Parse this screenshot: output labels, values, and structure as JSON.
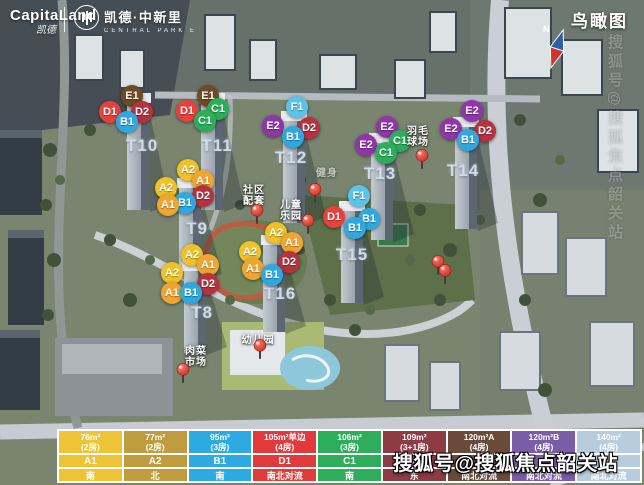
{
  "header": {
    "brand": "CapitaLand",
    "brand_sub": "凯德",
    "project": "凯德·中新里",
    "project_sub": "CENTRAL PARK E",
    "view_label": "鸟瞰图",
    "compass_n": "N"
  },
  "watermarks": {
    "bottom": "搜狐号@搜狐焦点韶关站",
    "side_vertical": "搜狐号@搜狐焦点韶关站"
  },
  "marker_colors": {
    "A1": "#F0A431",
    "A2": "#EFC228",
    "B1": "#2EA9E0",
    "C1": "#2BAE5B",
    "D1": "#E8403C",
    "D2": "#B5323F",
    "E1": "#6F4A24",
    "E2": "#9036A8",
    "F1": "#59C3EA"
  },
  "towers": [
    {
      "id": "T10",
      "x": 142,
      "y": 146
    },
    {
      "id": "T11",
      "x": 217,
      "y": 146
    },
    {
      "id": "T12",
      "x": 291,
      "y": 158
    },
    {
      "id": "T13",
      "x": 380,
      "y": 174
    },
    {
      "id": "T14",
      "x": 463,
      "y": 171
    },
    {
      "id": "T9",
      "x": 197,
      "y": 229
    },
    {
      "id": "T15",
      "x": 352,
      "y": 255
    },
    {
      "id": "T16",
      "x": 280,
      "y": 294
    },
    {
      "id": "T8",
      "x": 202,
      "y": 313
    }
  ],
  "unit_markers": [
    {
      "t": "E1",
      "x": 132,
      "y": 96
    },
    {
      "t": "D1",
      "x": 110,
      "y": 112
    },
    {
      "t": "D2",
      "x": 142,
      "y": 112
    },
    {
      "t": "B1",
      "x": 127,
      "y": 122
    },
    {
      "t": "E1",
      "x": 208,
      "y": 96
    },
    {
      "t": "D1",
      "x": 187,
      "y": 111
    },
    {
      "t": "C1",
      "x": 218,
      "y": 109
    },
    {
      "t": "C1",
      "x": 205,
      "y": 121
    },
    {
      "t": "F1",
      "x": 297,
      "y": 107
    },
    {
      "t": "E2",
      "x": 273,
      "y": 126
    },
    {
      "t": "D2",
      "x": 309,
      "y": 128
    },
    {
      "t": "B1",
      "x": 293,
      "y": 137
    },
    {
      "t": "E2",
      "x": 387,
      "y": 127
    },
    {
      "t": "C1",
      "x": 400,
      "y": 141
    },
    {
      "t": "E2",
      "x": 366,
      "y": 145
    },
    {
      "t": "C1",
      "x": 386,
      "y": 153
    },
    {
      "t": "E2",
      "x": 472,
      "y": 111
    },
    {
      "t": "E2",
      "x": 451,
      "y": 129
    },
    {
      "t": "D2",
      "x": 485,
      "y": 131
    },
    {
      "t": "B1",
      "x": 468,
      "y": 140
    },
    {
      "t": "A2",
      "x": 188,
      "y": 170
    },
    {
      "t": "A1",
      "x": 203,
      "y": 181
    },
    {
      "t": "A2",
      "x": 166,
      "y": 188
    },
    {
      "t": "D2",
      "x": 203,
      "y": 196
    },
    {
      "t": "B1",
      "x": 185,
      "y": 203
    },
    {
      "t": "A1",
      "x": 168,
      "y": 205
    },
    {
      "t": "F1",
      "x": 359,
      "y": 196
    },
    {
      "t": "D1",
      "x": 334,
      "y": 217
    },
    {
      "t": "B1",
      "x": 369,
      "y": 219
    },
    {
      "t": "B1",
      "x": 355,
      "y": 228
    },
    {
      "t": "A2",
      "x": 276,
      "y": 233
    },
    {
      "t": "A1",
      "x": 292,
      "y": 243
    },
    {
      "t": "A2",
      "x": 250,
      "y": 252
    },
    {
      "t": "D2",
      "x": 289,
      "y": 262
    },
    {
      "t": "A1",
      "x": 253,
      "y": 269
    },
    {
      "t": "B1",
      "x": 272,
      "y": 275
    },
    {
      "t": "A2",
      "x": 192,
      "y": 255
    },
    {
      "t": "A1",
      "x": 208,
      "y": 265
    },
    {
      "t": "A2",
      "x": 172,
      "y": 273
    },
    {
      "t": "D2",
      "x": 208,
      "y": 284
    },
    {
      "t": "A1",
      "x": 172,
      "y": 293
    },
    {
      "t": "B1",
      "x": 191,
      "y": 293
    }
  ],
  "facilities": [
    {
      "lines": [
        "社区",
        "配套"
      ],
      "x": 254,
      "y": 185,
      "faint": false
    },
    {
      "lines": [
        "儿童",
        "乐园"
      ],
      "x": 291,
      "y": 200,
      "faint": false
    },
    {
      "lines": [
        "健身"
      ],
      "x": 327,
      "y": 168,
      "faint": true
    },
    {
      "lines": [
        "羽毛",
        "球场"
      ],
      "x": 418,
      "y": 126,
      "faint": false
    },
    {
      "lines": [
        "幼儿园"
      ],
      "x": 258,
      "y": 335,
      "faint": false
    },
    {
      "lines": [
        "肉菜",
        "市场"
      ],
      "x": 196,
      "y": 346,
      "faint": false
    }
  ],
  "pins": [
    {
      "x": 257,
      "y": 217
    },
    {
      "x": 315,
      "y": 196
    },
    {
      "x": 308,
      "y": 227
    },
    {
      "x": 422,
      "y": 162
    },
    {
      "x": 438,
      "y": 268
    },
    {
      "x": 445,
      "y": 277
    },
    {
      "x": 260,
      "y": 352
    },
    {
      "x": 183,
      "y": 376
    }
  ],
  "legend": {
    "columns": [
      {
        "size": "76m²",
        "rooms": "(2房)",
        "unit": "A1",
        "orientation": "南",
        "color": "#EEC335"
      },
      {
        "size": "77m²",
        "rooms": "(2房)",
        "unit": "A2",
        "orientation": "北",
        "color": "#BF9C3E"
      },
      {
        "size": "95m²",
        "rooms": "(3房)",
        "unit": "B1",
        "orientation": "南",
        "color": "#2CAAE1"
      },
      {
        "size": "105m²单边",
        "rooms": "(4房)",
        "unit": "D1",
        "orientation": "南北对流",
        "color": "#E23A3C"
      },
      {
        "size": "106m²",
        "rooms": "(3房)",
        "unit": "C1",
        "orientation": "南",
        "color": "#2EAD5B"
      },
      {
        "size": "109m²",
        "rooms": "(3+1房)",
        "unit": "D2",
        "orientation": "东",
        "color": "#8E3B44"
      },
      {
        "size": "120m²A",
        "rooms": "(4房)",
        "unit": "",
        "orientation": "南北对流",
        "color": "#6B4A3A"
      },
      {
        "size": "120m²B",
        "rooms": "(4房)",
        "unit": "",
        "orientation": "南北对流",
        "color": "#7B5CA6"
      },
      {
        "size": "140m²",
        "rooms": "(4房)",
        "unit": "",
        "orientation": "南北对流",
        "color": "#B7CCDD"
      }
    ]
  }
}
